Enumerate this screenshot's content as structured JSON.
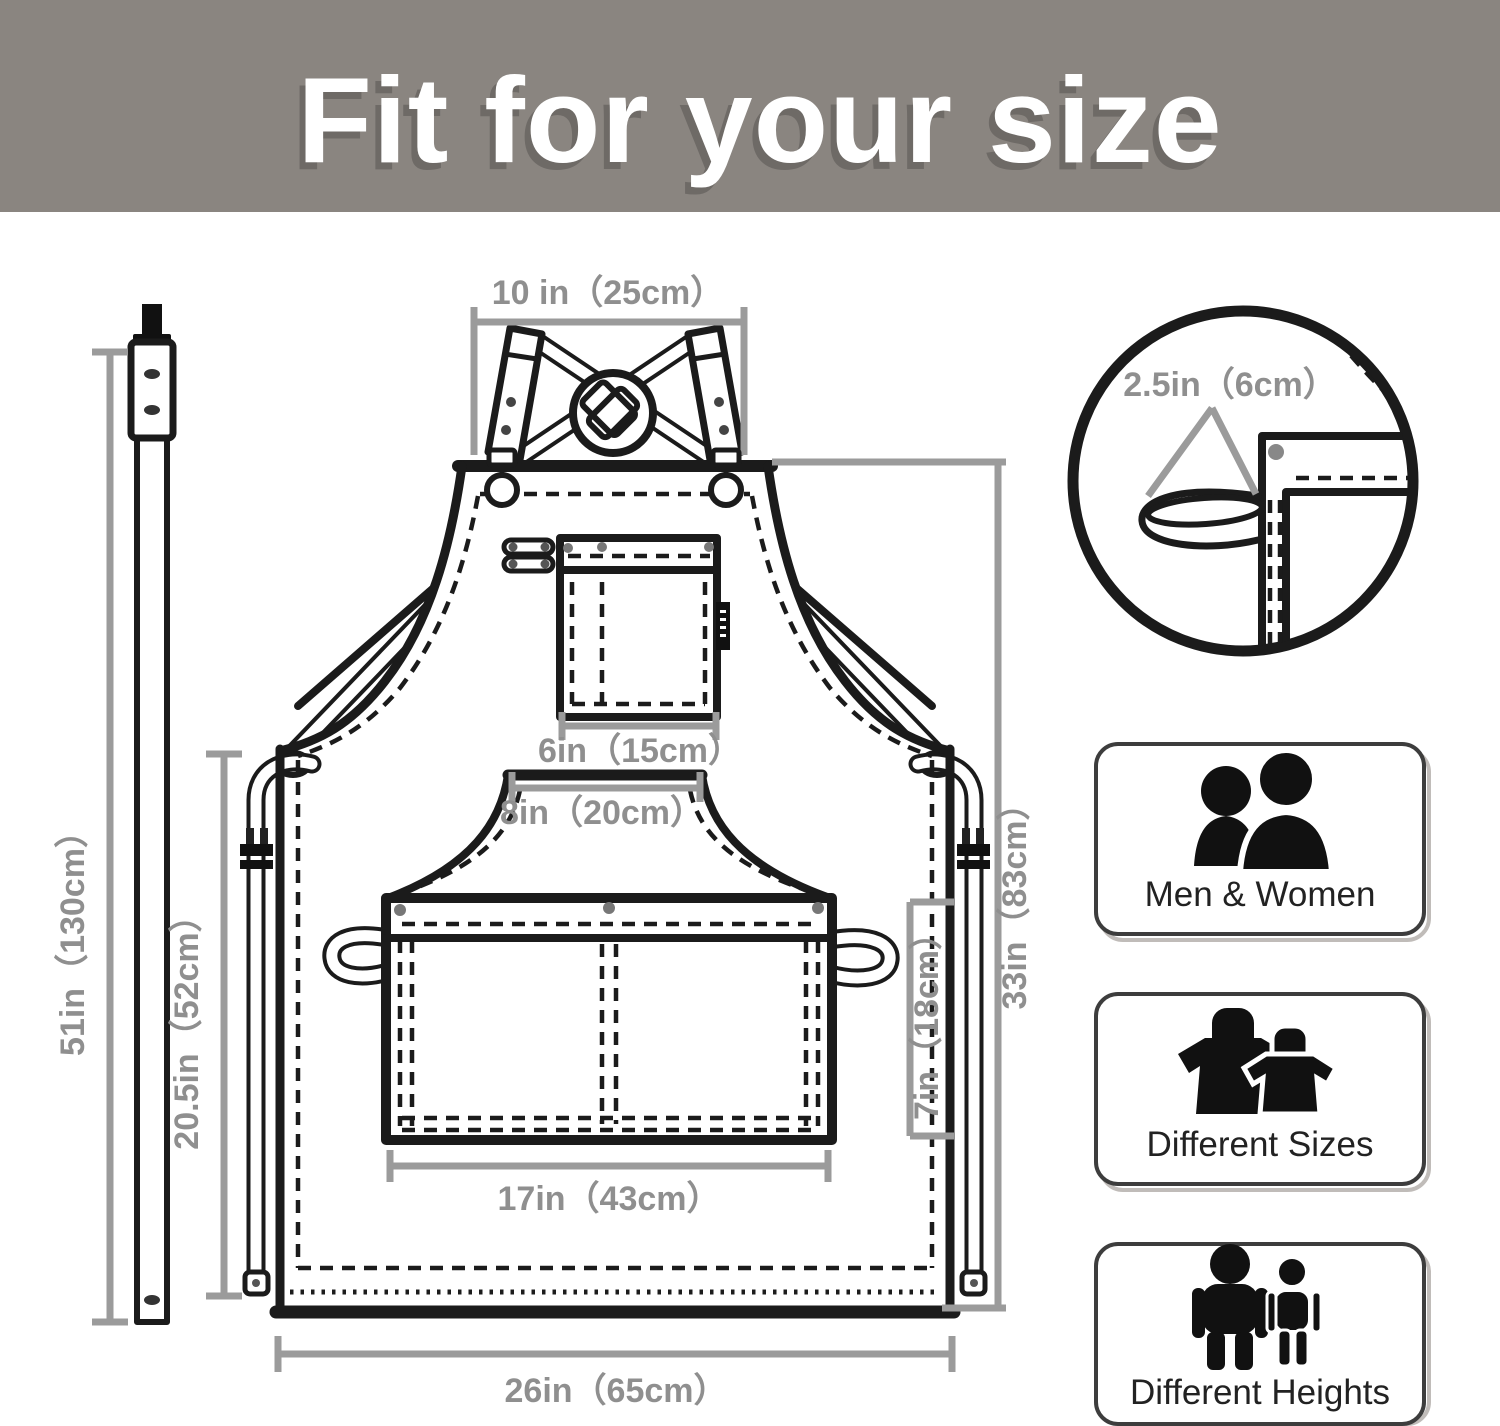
{
  "header": {
    "title": "Fit for your size"
  },
  "diagram": {
    "dimensions": {
      "neck_strap": "10 in（25cm）",
      "side_loop": "2.5in（6cm）",
      "chest_pocket": "6in（15cm）",
      "pocket_opening": "8in（20cm）",
      "front_pocket_width": "17in（43cm）",
      "front_pocket_height": "7in（18cm）",
      "bottom_width": "26in（65cm）",
      "strap_length": "51in（130cm）",
      "waist_tie": "20.5in（52cm）",
      "apron_length": "33in（83cm）"
    }
  },
  "features": [
    {
      "label": "Men & Women",
      "icon": "men-women-icon"
    },
    {
      "label": "Different Sizes",
      "icon": "different-sizes-icon"
    },
    {
      "label": "Different Heights",
      "icon": "different-heights-icon"
    }
  ],
  "colors": {
    "header_bg": "#8a8580",
    "header_text": "#ffffff",
    "line_art": "#1b1b1b",
    "dimension_lines": "#9b9b9b",
    "dimension_text": "#8f8f8f",
    "badge_border": "#3d3d3d",
    "icon_fill": "#111111"
  }
}
